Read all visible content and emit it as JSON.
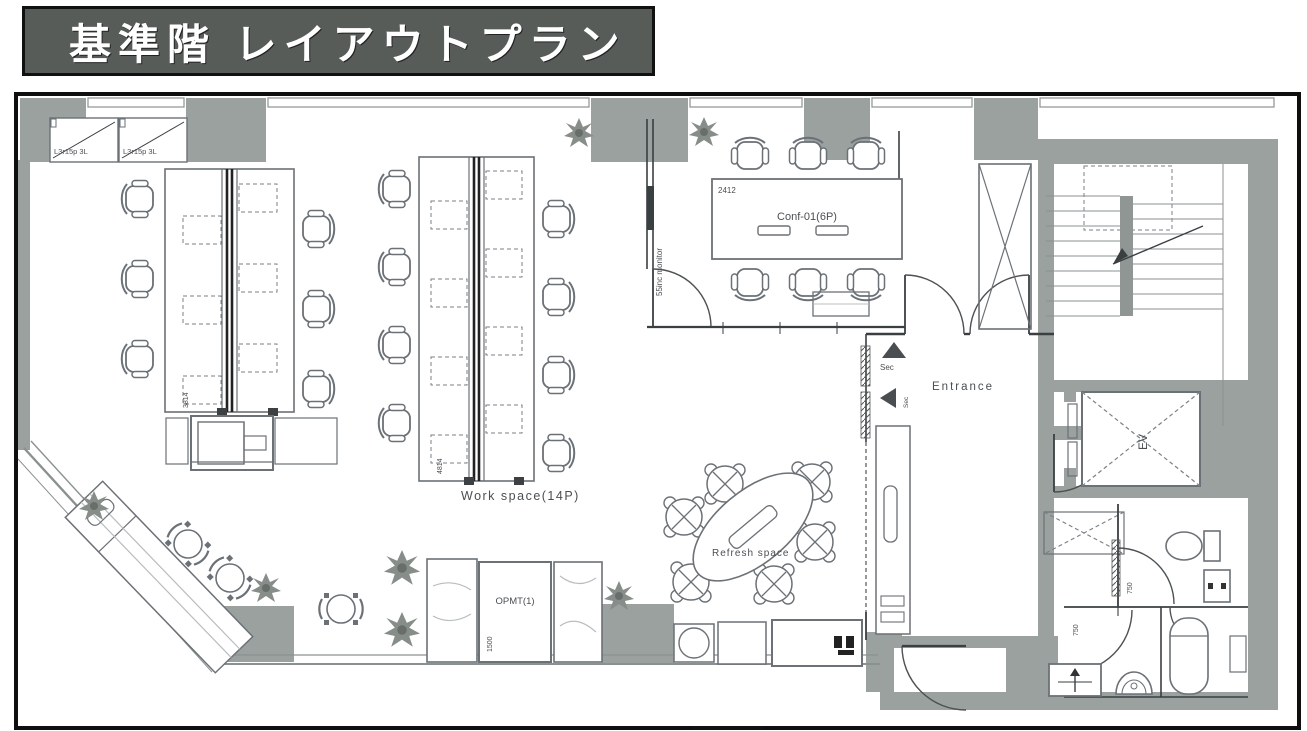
{
  "title": "基準階 レイアウトプラン",
  "colors": {
    "wall_gray": "#9aa19e",
    "banner_bg": "#575c58",
    "banner_text": "#ffffff",
    "line": "#3a3f42"
  },
  "rooms": {
    "storage": {
      "cabinet_label": "L3r15p 3L"
    },
    "conference": {
      "dim": "2412",
      "label": "Conf-01(6P)",
      "monitor": "55inc monitor"
    },
    "workspace": {
      "label": "Work space(14P)",
      "desk_dim_left": "3814",
      "desk_dim_center": "4814"
    },
    "refresh": {
      "label": "Refresh space"
    },
    "entrance": {
      "label": "Entrance",
      "sensor": "Sec"
    },
    "pantry": {
      "label": "OPMT(1)",
      "dim": "1500"
    },
    "elevator": {
      "label": "EV"
    },
    "toilet": {
      "dim": "750"
    }
  }
}
